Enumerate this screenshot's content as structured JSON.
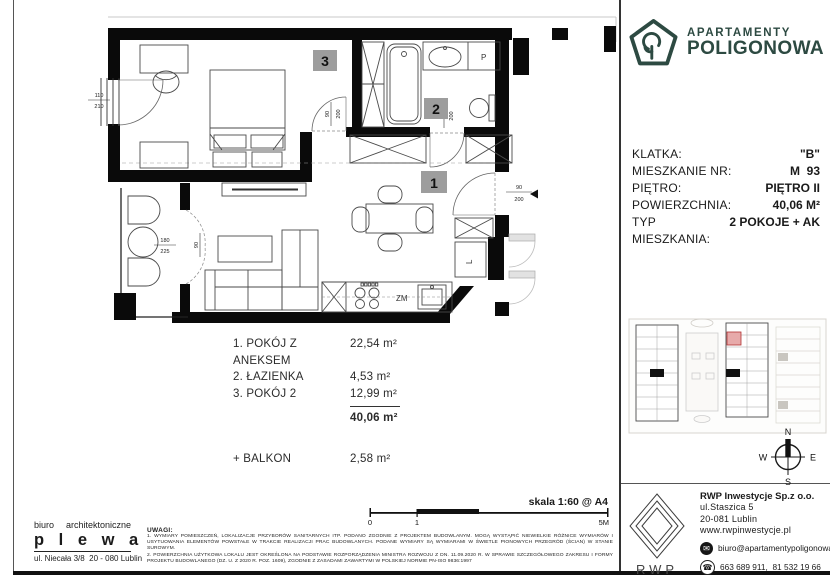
{
  "brand": {
    "line1": "APARTAMENTY",
    "line2": "POLIGONOWA",
    "color": "#2d4a42"
  },
  "info": {
    "rows": [
      {
        "label": "KLATKA:",
        "value": "\"B\""
      },
      {
        "label": "MIESZKANIE NR:",
        "value": "M  93"
      },
      {
        "label": "PIĘTRO:",
        "value": "PIĘTRO II"
      },
      {
        "label": "POWIERZCHNIA:",
        "value": "40,06 M²"
      },
      {
        "label": "TYP MIESZKANIA:",
        "value": "2 POKOJE + AK"
      }
    ]
  },
  "plan": {
    "badges": {
      "room1": "1",
      "room2": "2",
      "room3": "3"
    },
    "labels": {
      "washer": "P",
      "dishwasher": "ZM",
      "fridge": "L"
    },
    "dims": {
      "window_bedroom": {
        "w": "110",
        "h": "210"
      },
      "door_balcony": {
        "w": "180",
        "h": "225"
      },
      "door_balcony_leaf": "90",
      "door_bedroom": {
        "w": "90",
        "h": "200"
      },
      "door_bathroom": {
        "w": "90",
        "h": "200"
      },
      "door_entrance": {
        "w": "90",
        "h": "200"
      }
    }
  },
  "rooms": {
    "items": [
      {
        "name": "1. POKÓJ Z ANEKSEM",
        "area": "22,54 m²"
      },
      {
        "name": "2. ŁAZIENKA",
        "area": "4,53 m²"
      },
      {
        "name": "3. POKÓJ 2",
        "area": "12,99 m²"
      }
    ],
    "total": "40,06 m²",
    "balcony_name": "+ BALKON",
    "balcony_area": "2,58 m²"
  },
  "scalebar": {
    "label": "skala 1:60 @ A4",
    "tick0": "0",
    "tick1": "1",
    "tick5": "5M"
  },
  "architect": {
    "word1": "biuro",
    "word2": "architektoniczne",
    "name": "p l e w a",
    "address": "ul. Niecała 3/8  20 - 080 Lublin"
  },
  "notes": {
    "title": "UWAGI:",
    "p1": "1. WYMIARY POMIESZCZEŃ, LOKALIZACJE PRZYBORÓW SANITARNYCH ITP. PODANO ZGODNIE Z PROJEKTEM BUDOWLANYM. MOGĄ WYSTĄPIĆ NIEWIELKIE RÓŻNICE WYMIARÓW I USYTUOWANIA ELEMENTÓW POWSTAŁE W TRAKCIE REALIZACJI PRAC BUDOWLANYCH. PODANE WYMIARY SĄ WYMIARAMI W ŚWIETLE PIONOWYCH PRZEGRÓD (ŚCIAN) W STANIE SUROWYM.",
    "p2": "2. POWIERZCHNIA UŻYTKOWA LOKALU JEST OKREŚLONA NA PODSTAWIE ROZPORZĄDZENIA MINISTRA ROZWOJU Z DN. 11.09.2020 R. W SPRAWIE SZCZEGÓŁOWEGO ZAKRESU I FORMY PROJEKTU BUDOWLANEGO (DZ. U. Z 2020 R. POZ. 1609), ZGODNIE Z ZASADAMI ZAWARTYMI W POLSKIEJ NORMIE PN-ISO 9836:1997"
  },
  "developer": {
    "logo": "RWP",
    "company": "RWP Inwestycje Sp.z o.o.",
    "street": "ul.Staszica 5",
    "city": "20-081 Lublin",
    "website": "www.rwpinwestycje.pl",
    "email": "biuro@apartamentypoligonowa.pl",
    "phones": "663 689 911,  81 532 19 66"
  },
  "compass": {
    "n": "N",
    "e": "E",
    "w": "W",
    "s": "S"
  }
}
